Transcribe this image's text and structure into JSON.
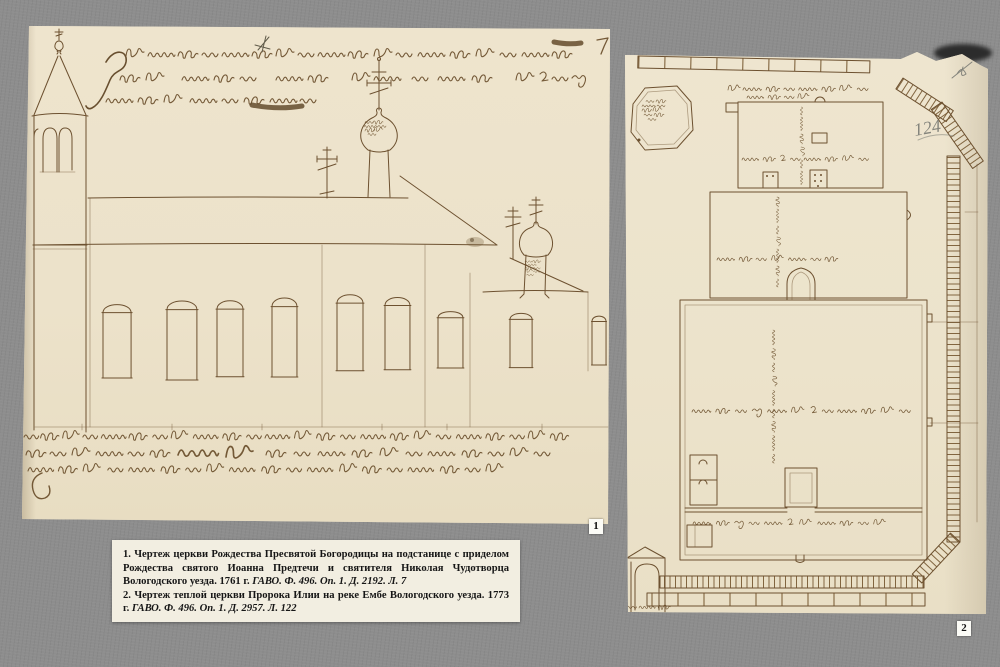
{
  "page": {
    "background_color": "#8d8d8d"
  },
  "colors": {
    "paper": "#ece2ca",
    "ink": "#6d5130",
    "handwriting_ink": "#6a4e2b",
    "pencil": "#84847c",
    "caption_background": "#f2eee1",
    "badge_background": "#fbfbf6"
  },
  "figure1": {
    "badge": "1"
  },
  "figure2": {
    "badge": "2",
    "pencil_note": "124"
  },
  "caption": {
    "entries": [
      {
        "number": "1.",
        "text": "Чертеж церкви Рождества Пресвятой Богородицы на подстанице с приделом Рождества святого Иоанна Предтечи и святителя Николая Чудотворца Вологодского уезда. 1761 г.",
        "reference": "ГАВО. Ф. 496. Оп. 1. Д. 2192. Л. 7"
      },
      {
        "number": "2.",
        "text": "Чертеж теплой церкви Пророка Илии на реке Ембе Вологодского уезда. 1773 г.",
        "reference": "ГАВО. Ф. 496. Оп. 1. Д. 2957. Л. 122"
      }
    ]
  }
}
